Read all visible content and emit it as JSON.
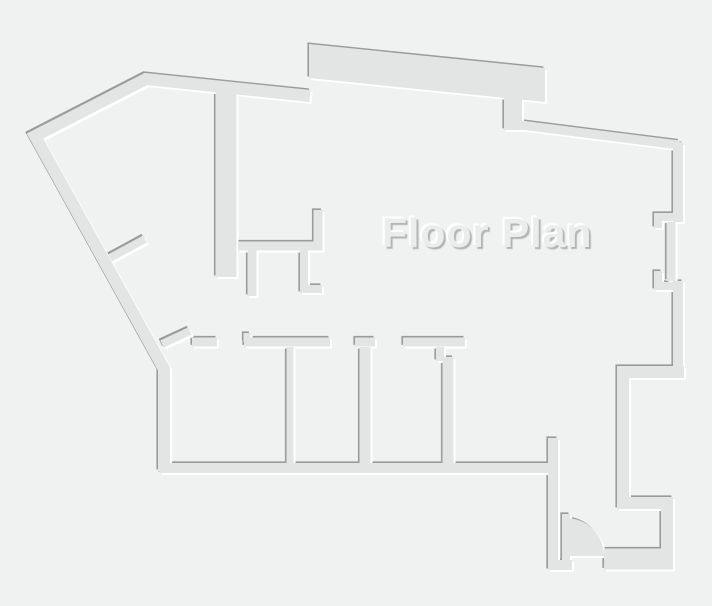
{
  "title": {
    "text": "Floor Plan"
  },
  "colors": {
    "background": "#f0f1f1",
    "wall_fill": "#e3e5e5",
    "wall_shadow": "#999c9c",
    "wall_highlight": "#ffffff",
    "title_fill": "#ebecec",
    "title_shadow": "#b2b5b5"
  },
  "floor_plan": {
    "canvas": {
      "width": 712,
      "height": 606
    },
    "emboss": {
      "shadow_dx": -1.6,
      "shadow_dy": -1.6,
      "highlight_dx": 2,
      "highlight_dy": 2
    },
    "polygons": [
      {
        "name": "top-terrace-band",
        "points": "309,44 545,68 545,102 309,78"
      }
    ],
    "walls": [
      {
        "name": "exterior-left-wall",
        "d": "M310,96 L146,79 L35,136 L164,369 L164,471",
        "w": 12
      },
      {
        "name": "terrace-tab-wall",
        "d": "M513,98 L513,130",
        "w": 18
      },
      {
        "name": "top-right-wall",
        "d": "M513,124 L679,145",
        "w": 9
      },
      {
        "name": "right-wall-upper",
        "d": "M678,143 L678,222",
        "w": 10
      },
      {
        "name": "right-wall-recessed",
        "d": "M671,222 L671,281",
        "w": 9
      },
      {
        "name": "right-wall-lower",
        "d": "M678,281 L678,372",
        "w": 10
      },
      {
        "name": "right-opening-jamb-upper",
        "d": "M674,217 L658,217 L658,228",
        "w": 8
      },
      {
        "name": "right-opening-jamb-lower",
        "d": "M658,271 L658,286 L674,286",
        "w": 8
      },
      {
        "name": "right-jog-wall",
        "d": "M684,372 L623,372 L623,503 L667,503 L667,561",
        "w": 12
      },
      {
        "name": "bottom-right-wall",
        "d": "M604,559 L673,559",
        "w": 21
      },
      {
        "name": "bottom-door-sill-wall",
        "d": "M548,565 L572,565",
        "w": 10
      },
      {
        "name": "corridor-left-wall",
        "d": "M553,438 L553,570",
        "w": 10
      },
      {
        "name": "rooms-bottom-wall",
        "d": "M160,468 L558,468",
        "w": 10
      },
      {
        "name": "interior-main-vertical-wall",
        "d": "M226,88 L226,277",
        "w": 21
      },
      {
        "name": "closet-wall",
        "d": "M238,246 L318,246 L318,210",
        "w": 9
      },
      {
        "name": "closet-stub-left",
        "d": "M252,250 L252,296",
        "w": 9
      },
      {
        "name": "closet-stub-right",
        "d": "M304,250 L304,289 L322,289",
        "w": 8
      },
      {
        "name": "diagonal-partition-upper",
        "d": "M110,258 L145,239",
        "w": 8
      },
      {
        "name": "diagonal-partition-lower",
        "d": "M162,344 L190,331",
        "w": 8
      },
      {
        "name": "room1-top-wall",
        "d": "M192,342 L217,342",
        "w": 9
      },
      {
        "name": "room2-top-wall",
        "d": "M244,342 L330,342",
        "w": 9
      },
      {
        "name": "room2-door-jamb",
        "d": "M247,333 L247,342",
        "w": 7
      },
      {
        "name": "room-divider-1",
        "d": "M290,347 L290,468",
        "w": 7
      },
      {
        "name": "room3-top-stub",
        "d": "M355,342 L375,342",
        "w": 9
      },
      {
        "name": "room-divider-2",
        "d": "M365,347 L365,468",
        "w": 11
      },
      {
        "name": "room4-top-wall",
        "d": "M403,342 L465,342",
        "w": 9
      },
      {
        "name": "room4-door-jamb",
        "d": "M440,347 L440,361",
        "w": 8
      },
      {
        "name": "room-divider-3",
        "d": "M448,357 L448,468",
        "w": 11
      }
    ],
    "door": {
      "leaf_d": "M566,514 L566,560",
      "leaf_w": 8,
      "swing_d": "M566,518 A38,38 0 0 1 604,556 L566,556 Z"
    }
  }
}
